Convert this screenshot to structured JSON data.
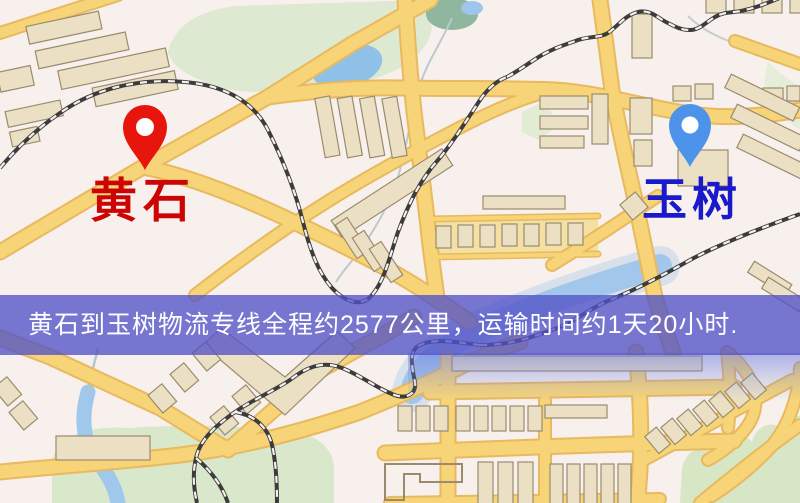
{
  "map": {
    "origin": {
      "label": "黄石",
      "label_color": "#cc0404",
      "pin_icon": "red-map-pin",
      "pin_color": "#e8150c"
    },
    "destination": {
      "label": "玉树",
      "label_color": "#1a1acd",
      "pin_icon": "blue-map-pin",
      "pin_color": "#4e93ea"
    },
    "palette": {
      "background": "#f7f0ec",
      "road": "#f7d478",
      "road_casing": "#e8b95e",
      "building": "#ece0c4",
      "park": "#dde9d0",
      "water": "#8fc0e8",
      "railway": "#3c3c3c",
      "banner": "#5252c8"
    }
  },
  "banner": {
    "text": "黄石到玉树物流专线全程约2577公里，运输时间约1天20小时.",
    "text_color": "#ffffff"
  },
  "route": {
    "origin": "黄石",
    "destination": "玉树",
    "service": "物流专线",
    "distance": "约2577公里",
    "duration": "约1天20小时"
  }
}
